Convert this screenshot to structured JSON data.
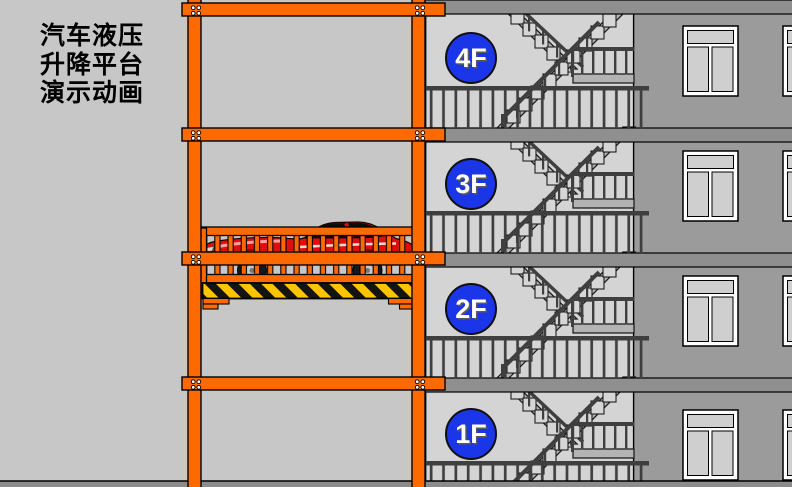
{
  "title": {
    "lines": [
      "汽车液压",
      "升降平台",
      "演示动画"
    ]
  },
  "building": {
    "floors": [
      {
        "label": "4F"
      },
      {
        "label": "3F"
      },
      {
        "label": "2F"
      },
      {
        "label": "1F"
      }
    ]
  },
  "colors": {
    "background": "#C7C7C7",
    "frame_orange": "#FF6A00",
    "badge_blue": "#1A36E8",
    "badge_text": "#FFFFFF",
    "car_red": "#E20C0C",
    "hazard_yellow": "#FFC400",
    "hazard_black": "#141414",
    "wall_gray": "#9B9B9B",
    "stairwell_gray": "#D4D4D4",
    "slab_gray": "#8F8F8F",
    "railing_gray": "#3F3F3F",
    "stair_gray": "#B3B3B3",
    "step_gray": "#D6D6D6"
  }
}
